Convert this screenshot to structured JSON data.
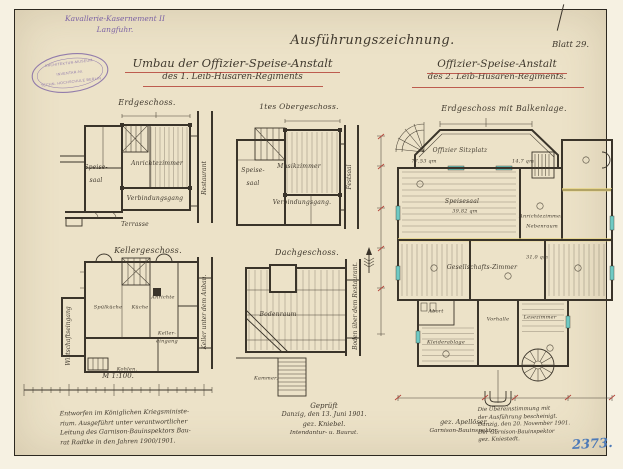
{
  "colors": {
    "paper": "#ece2c8",
    "ink": "#3a342a",
    "purple_ink": "#7c63a5",
    "red_underline": "#b5443a",
    "blue_crayon": "#4d7ab8",
    "teal_accent": "#6fcac4",
    "yellow_accent": "#e6d37e"
  },
  "header": {
    "site_line1": "Kavallerie-Kasernement II",
    "site_line2": "Langfuhr.",
    "title": "Ausführungszeichnung.",
    "left_sub1": "Umbau der Offizier-Speise-Anstalt",
    "left_sub2": "des 1. Leib-Husaren-Regiments",
    "right_sub1": "Offizier-Speise-Anstalt",
    "right_sub2": "des 2. Leib-Husaren-Regiments.",
    "sheet": "Blatt 29."
  },
  "stamp": {
    "line1": "ARCHITEKTUR-MUSEUM",
    "line2": "INVENTAR-Nr.",
    "line3": "TECHN. HOCHSCHULE BERLIN"
  },
  "plans": {
    "erdgeschoss": {
      "title": "Erdgeschoss.",
      "speise1": "Speise-",
      "speise2": "saal",
      "anrichte": "Anrichtezimmer",
      "gang": "Verbindungsgang",
      "terrasse": "Terrasse",
      "restaurant": "Restaurant"
    },
    "obergeschoss": {
      "title": "1tes Obergeschoss.",
      "speise1": "Speise-",
      "speise2": "saal",
      "musik": "Musikzimmer",
      "gang": "Verbindungsgang.",
      "festsaal": "Festsaal"
    },
    "kellergeschoss": {
      "title": "Kellergeschoss.",
      "spuelkueche": "Spülküche",
      "kueche": "Küche",
      "anrichte": "Anrichte",
      "keller1": "Keller-",
      "keller2": "eingang",
      "kohlen": "Kohlen.",
      "gang": "Wirtschaftseingang",
      "anbau": "Keller unter dem Anbau."
    },
    "dachgeschoss": {
      "title": "Dachgeschoss.",
      "boden": "Bodenraum",
      "kammer": "Kammer.",
      "side": "Boden über dem Restaurant."
    },
    "hauptplan": {
      "title": "Erdgeschoss mit Balkenlage.",
      "sitzplatz": "Offizier Sitzplatz",
      "sitzplatz_qm": "77,53 qm",
      "speisesaal": "Speisesaal",
      "speisesaal_qm": "39,82 qm",
      "anrichte": "Anrichtezimmer",
      "nebenraum": "Nebenraum",
      "anrichte_qm": "14,7 qm",
      "gesellschaft": "Gesellschafts-Zimmer",
      "gesellschaft_qm": "31,0 qm",
      "vorhalle": "Vorhalle",
      "lesezimmer": "Lesezimmer",
      "kleiderablage": "Kleiderablage",
      "abort": "Abort"
    }
  },
  "scalebar": {
    "label": "M 1:100."
  },
  "notes": {
    "left": [
      "Entworfen im Königlichen Kriegsministe-",
      "rium. Ausgeführt unter verantwortlicher",
      "Leitung des Garnison-Bauinspektors Bau-",
      "rat Radtke in den Jahren 1900/1901."
    ],
    "approval": {
      "checked": "Geprüft",
      "place_date": "Danzig, den 13. Juni 1901.",
      "sig_left": "gez. Kniebel.",
      "sig_right": "gez. Apellöser.",
      "role_left": "Intendantur- u. Baurat.",
      "role_right": "Garnison-Bauinspektor."
    },
    "certify": [
      "Die Übereinstimmung mit",
      "der Ausführung bescheinigt.",
      "Danzig, den 20. November 1901.",
      "Der Garnison-Bauinspektor",
      "gez. Kniestedt."
    ],
    "archive_number": "2373."
  }
}
